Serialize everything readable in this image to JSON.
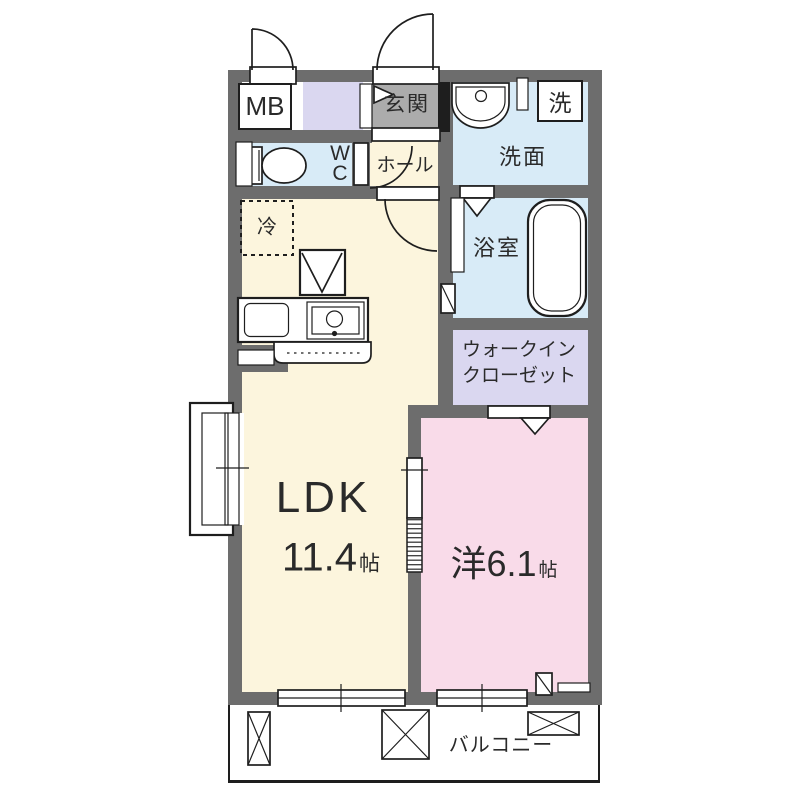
{
  "document": {
    "type": "apartment-floor-plan"
  },
  "colors": {
    "wall": "#6d6d6d",
    "line": "#1e1e1e",
    "text": "#2a2a2a",
    "ldk-fill": "#fcf5dd",
    "wet-fill": "#d8ebf7",
    "closet-fill": "#dad7f0",
    "bedroom-fill": "#f9dbe9",
    "entrance-fill": "#acacac"
  },
  "rooms": {
    "meter_box": {
      "label": "MB"
    },
    "entrance": {
      "label": "玄関"
    },
    "laundry": {
      "label": "洗"
    },
    "washroom": {
      "label": "洗面"
    },
    "toilet": {
      "label": "W\nC"
    },
    "hall": {
      "label": "ホール"
    },
    "bathroom": {
      "label": "浴室"
    },
    "refrigerator": {
      "label": "冷"
    },
    "walk_in_closet": {
      "label": "ウォークイン\nクローゼット"
    },
    "ldk": {
      "label": "LDK",
      "size": "11.4",
      "size_unit": "帖"
    },
    "bedroom": {
      "label": "洋6.1",
      "size_unit": "帖"
    },
    "balcony": {
      "label": "バルコニー"
    }
  },
  "fixtures": [
    "entry-swing-door",
    "meter-box-door",
    "entrance-step",
    "entrance-direction-arrow",
    "wash-basin",
    "washing-machine-space",
    "toilet",
    "bathtub",
    "folding-bath-door",
    "kitchen-counter",
    "kitchen-sink",
    "range-hood-symbol",
    "refrigerator-space",
    "sliding-door",
    "sliding-windows",
    "bay-window",
    "pipe-space",
    "balcony-equipment"
  ]
}
